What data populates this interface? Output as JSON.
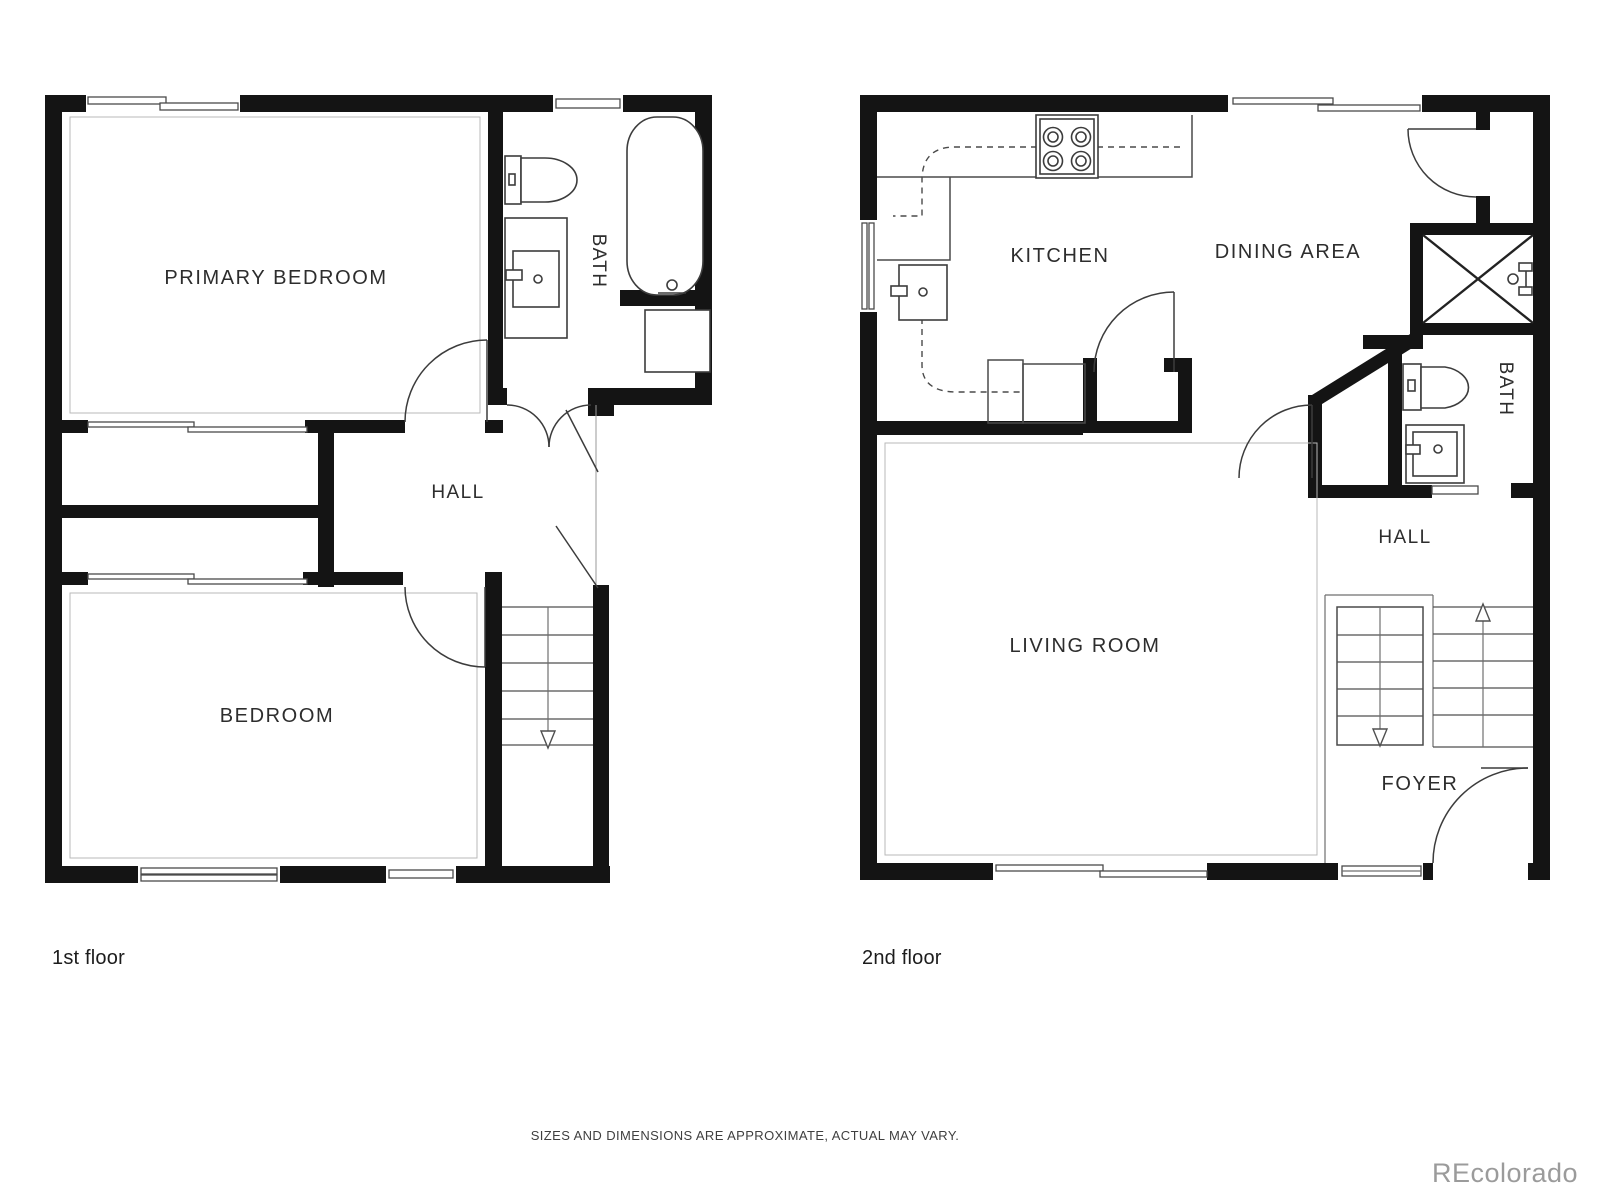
{
  "colors": {
    "wall": "#141414",
    "line": "#4a4a4a",
    "text": "#2d2d2d",
    "watermark": "#9b9b9b",
    "background": "#ffffff"
  },
  "plans": [
    {
      "caption": "1st floor",
      "labels": {
        "primary_bedroom": "PRIMARY BEDROOM",
        "bath": "BATH",
        "hall": "HALL",
        "bedroom": "BEDROOM"
      }
    },
    {
      "caption": "2nd floor",
      "labels": {
        "kitchen": "KITCHEN",
        "dining_area": "DINING AREA",
        "bath": "BATH",
        "hall": "HALL",
        "living_room": "LIVING ROOM",
        "foyer": "FOYER"
      }
    }
  ],
  "footer": {
    "disclaimer": "SIZES AND DIMENSIONS ARE APPROXIMATE, ACTUAL MAY VARY.",
    "watermark": "REcolorado"
  }
}
